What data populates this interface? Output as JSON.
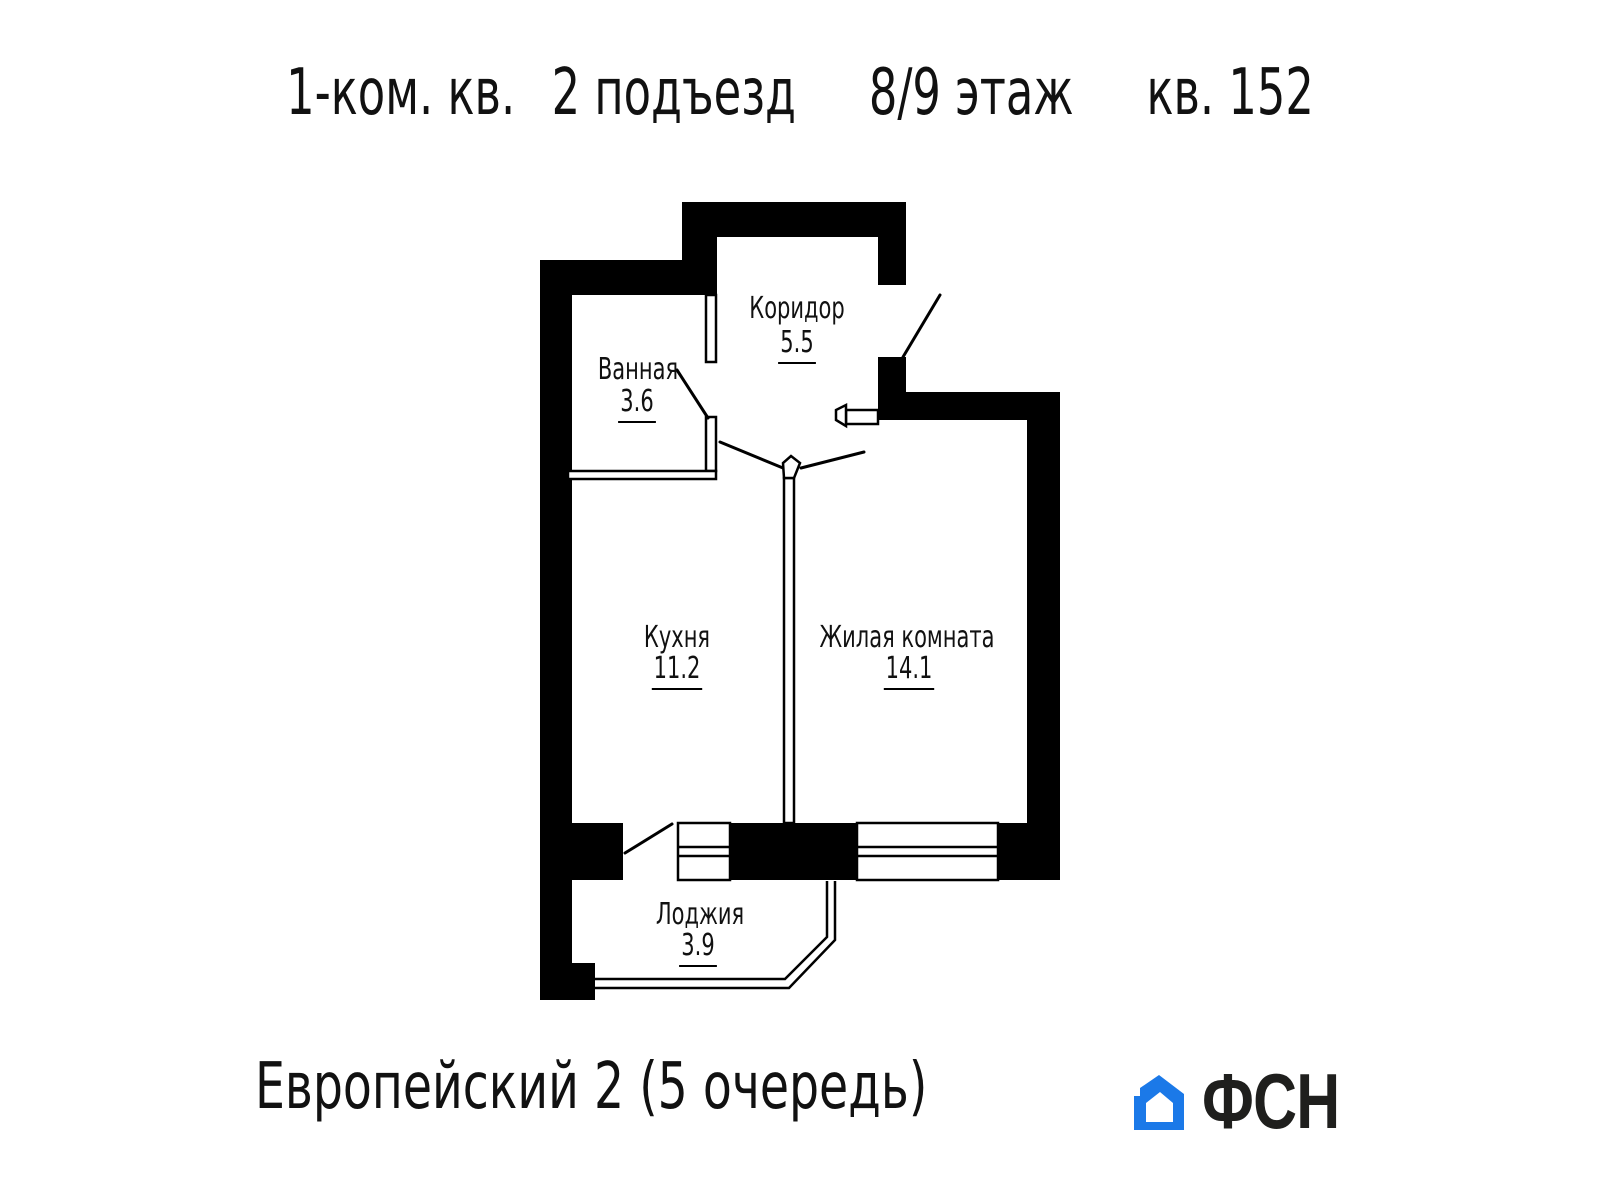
{
  "header": {
    "unit_type": "1-ком. кв.",
    "entrance": "2 подъезд",
    "floor": "8/9 этаж",
    "apartment": "кв. 152"
  },
  "plan": {
    "rooms": [
      {
        "id": "corridor",
        "name": "Коридор",
        "area": "5.5"
      },
      {
        "id": "bathroom",
        "name": "Ванная",
        "area": "3.6"
      },
      {
        "id": "kitchen",
        "name": "Кухня",
        "area": "11.2"
      },
      {
        "id": "living",
        "name": "Жилая комната",
        "area": "14.1"
      },
      {
        "id": "loggia",
        "name": "Лоджия",
        "area": "3.9"
      }
    ]
  },
  "footer": {
    "project": "Европейский 2 (5 очередь)",
    "logo_text": "ФСН",
    "logo_icon": "house-icon"
  },
  "colors": {
    "background": "#ffffff",
    "walls": "#000000",
    "lines": "#000000",
    "text": "#111111",
    "logo_blue": "#1b79e8",
    "logo_text": "#1f1f1d"
  }
}
